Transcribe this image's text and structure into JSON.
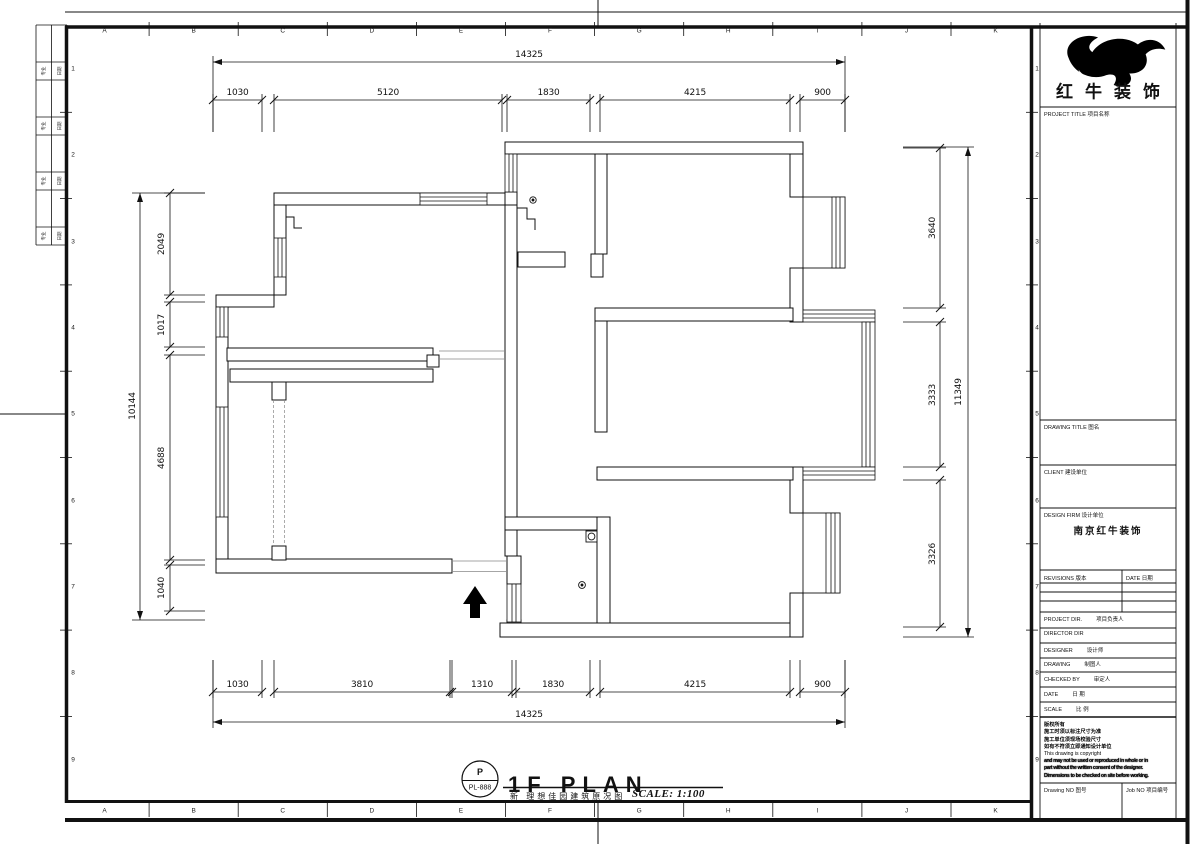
{
  "sheet": {
    "grid_letters": [
      "A",
      "B",
      "C",
      "D",
      "E",
      "F",
      "G",
      "H",
      "I",
      "J",
      "K"
    ],
    "grid_numbers": [
      "1",
      "2",
      "3",
      "4",
      "5",
      "6",
      "7",
      "8",
      "9"
    ],
    "signoff_rows": [
      {
        "left": "专业",
        "right": "日期"
      },
      {
        "left": "专业",
        "right": "日期"
      },
      {
        "left": "专业",
        "right": "日期"
      },
      {
        "left": "专业",
        "right": "日期"
      }
    ]
  },
  "plan": {
    "title": "1F PLAN",
    "subtitle": "新 理想佳园建筑原况图",
    "scale_note": "SCALE: 1:100",
    "stamp_top": "P",
    "stamp_bottom": "PL-888"
  },
  "dims": {
    "top_overall": "14325",
    "top": [
      "1030",
      "5120",
      "1830",
      "4215",
      "900"
    ],
    "bottom": [
      "1030",
      "3810",
      "1310",
      "1830",
      "4215",
      "900"
    ],
    "bottom_overall": "14325",
    "left": [
      "2049",
      "1017",
      "4688",
      "1040"
    ],
    "left_overall": "10144",
    "right": [
      "3640",
      "3333",
      "3326"
    ],
    "right_overall": "11349"
  },
  "titleblock": {
    "logo_text": "红牛装饰",
    "project_title_label": "PROJECT TITLE  项目名称",
    "drawing_title_label": "DRAWING TITLE  图名",
    "client_label": "CLIENT  建设单位",
    "design_firm_label": "DESIGN FIRM  设计单位",
    "design_firm_value": "南京红牛装饰",
    "revisions_label": "REVISIONS  版本",
    "revision_date_label": "DATE  日期",
    "rows": [
      {
        "en": "PROJECT DIR.",
        "cn": "项目负责人"
      },
      {
        "en": "DIRECTOR DIR",
        "cn": ""
      },
      {
        "en": "DESIGNER",
        "cn": "设计师"
      },
      {
        "en": "DRAWING",
        "cn": "制图人"
      },
      {
        "en": "CHECKED BY",
        "cn": "审定人"
      },
      {
        "en": "DATE",
        "cn": "日  期"
      },
      {
        "en": "SCALE",
        "cn": "比  例"
      }
    ],
    "copyright_lines": [
      "版权所有",
      "施工时须以标注尺寸为准",
      "施工单位须现场校验尺寸",
      "如有不符须立即通知设计单位",
      "This drawing is copyright",
      "and may not be used or reproduced in whole or in",
      "part without the written consent of the designer.",
      "Dimensions to be checked on site before working."
    ],
    "drawing_no_label": "Drawing NO  图号",
    "job_no_label": "Job NO  项目编号"
  }
}
